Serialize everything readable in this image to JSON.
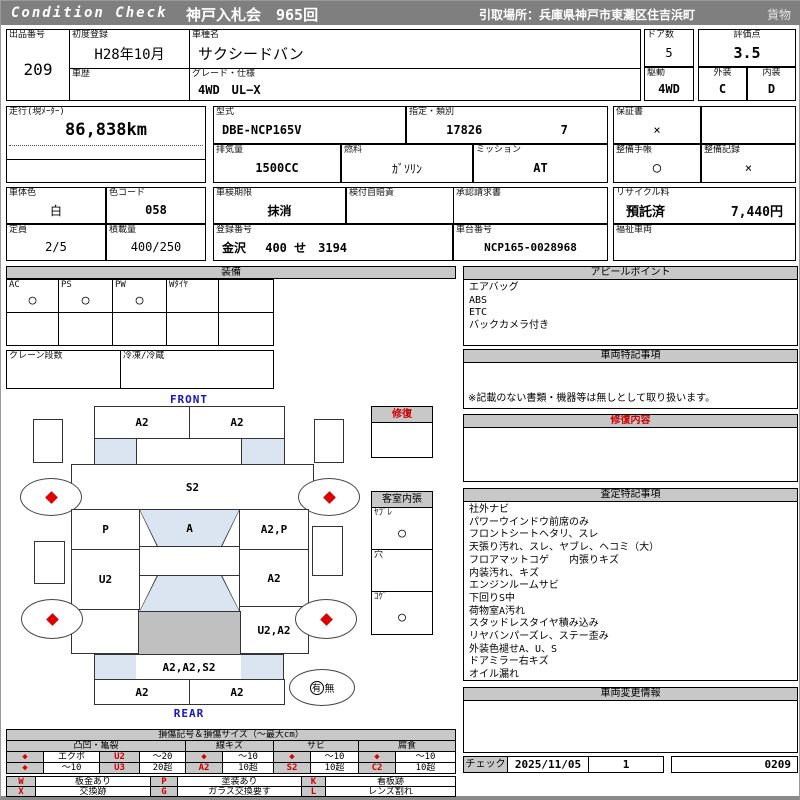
{
  "header": {
    "brand": "Condition Check",
    "auction": "神戸入札会　965回",
    "pickup": "引取場所：兵庫県神戸市東灘区住吉浜町",
    "cargo": "貨物"
  },
  "info": {
    "lot_label": "出品番号",
    "lot": "209",
    "first_reg_label": "初度登録",
    "first_reg": "H28年10月",
    "history_label": "車歴",
    "history": "",
    "model_label": "車種名",
    "model": "サクシードバン",
    "grade_label": "グレード・仕様",
    "grade": "4WD　UL−X",
    "doors_label": "ドア数",
    "doors": "5",
    "drive_label": "駆動",
    "drive": "4WD",
    "score_label": "評価点",
    "score": "3.5",
    "exterior_label": "外装",
    "exterior": "C",
    "interior_label": "内装",
    "interior": "D"
  },
  "specs": {
    "mileage_label": "走行(現ﾒｰﾀｰ)",
    "mileage": "86,838km",
    "model_code_label": "型式",
    "model_code": "DBE-NCP165V",
    "class_label": "指定・類別",
    "class_no": "17826",
    "class_sub": "7",
    "displacement_label": "排気量",
    "displacement": "1500CC",
    "fuel_label": "燃料",
    "fuel": "ｶﾞｿﾘﾝ",
    "transmission_label": "ミッション",
    "transmission": "AT",
    "warranty_label": "保証書",
    "warranty": "×",
    "maintenance_book_label": "整備手帳",
    "maintenance_book": "○",
    "maintenance_record_label": "整備記録",
    "maintenance_record": "×"
  },
  "registration": {
    "color_label": "車体色",
    "color": "白",
    "color_code_label": "色コード",
    "color_code": "058",
    "capacity_label": "定員",
    "capacity": "2/5",
    "load_label": "積載量",
    "load": "400/250",
    "inspection_label": "車検期限",
    "inspection": "抹消",
    "insurance_label": "検付自賠責",
    "insurance": "×",
    "plate_label": "登録番号",
    "plate": "金沢　 400 せ　3194",
    "vin_label": "車台番号",
    "vin": "NCP165-0028968",
    "approval_label": "承認請求書",
    "approval": "",
    "recycle_label": "リサイクル料",
    "recycle_status": "預託済",
    "recycle_fee": "7,440円",
    "welfare_label": "福祉車両",
    "welfare": ""
  },
  "equipment": {
    "title": "装備",
    "items": [
      {
        "label": "AC",
        "value": "○"
      },
      {
        "label": "PS",
        "value": "○"
      },
      {
        "label": "PW",
        "value": "○"
      },
      {
        "label": "Wﾀｲﾔ",
        "value": ""
      },
      {
        "label": "",
        "value": ""
      }
    ],
    "crane_label": "クレーン段数",
    "crane": "",
    "fridge_label": "冷凍/冷蔵",
    "fridge": ""
  },
  "diagram": {
    "front_label": "FRONT",
    "rear_label": "REAR",
    "zones": {
      "front_bumper_l": "A2",
      "front_bumper_r": "A2",
      "hood": "S2",
      "windshield": "A",
      "front_door_l": "P",
      "front_door_r": "A2,P",
      "rear_door_l": "U2",
      "rear_door_r": "A2",
      "rear_quarter_r": "U2,A2",
      "tail_panel": "A2,A2,S2",
      "rear_bumper_l": "A2",
      "rear_bumper_r": "A2"
    },
    "spare_yes": "有",
    "spare_no": "無"
  },
  "repair_box": {
    "title": "修復"
  },
  "interior_trim": {
    "title": "客室内張",
    "tear_label": "ﾔﾌﾞﾚ",
    "tear": "○",
    "hole_label": "穴",
    "hole": "",
    "burn_label": "ｺｹﾞ",
    "burn": "○"
  },
  "panels": {
    "appeal": {
      "title": "アピールポイント",
      "items": [
        "エアバッグ",
        "ABS",
        "ETC",
        "バックカメラ付き"
      ]
    },
    "vehicle_notes": {
      "title": "車両特記事項",
      "note": "※記載のない書類・機器等は無しとして取り扱います。"
    },
    "repair_detail": {
      "title": "修復内容",
      "content": ""
    },
    "assessment": {
      "title": "査定特記事項",
      "items": [
        "社外ナビ",
        "パワーウインドウ前席のみ",
        "フロントシートヘタリ、スレ",
        "天張り汚れ、スレ、ヤブレ、ヘコミ（大）",
        "フロアマットコゲ　　内張りキズ",
        "内装汚れ、キズ",
        "エンジンルームサビ",
        "下回りS中",
        "荷物室A汚れ",
        "スタッドレスタイヤ積み込み",
        "リヤバンパーズレ、ステー歪み",
        "外装色褪せA、U、S",
        "ドアミラー右キズ",
        "オイル漏れ"
      ]
    },
    "change_info": {
      "title": "車両変更情報",
      "content": ""
    }
  },
  "check": {
    "label": "チェック",
    "date": "2025/11/05",
    "count": "1",
    "code": "0209"
  },
  "legend": {
    "title": "損傷記号＆損傷サイズ（〜最大cm）",
    "diamond": "◆",
    "groups": [
      {
        "name": "凸凹・亀裂",
        "rows": [
          [
            "◆",
            "エクボ",
            "U2",
            "〜20"
          ],
          [
            "◆",
            "〜10",
            "U3",
            "20超"
          ]
        ]
      },
      {
        "name": "線キズ",
        "rows": [
          [
            "◆",
            "〜10"
          ],
          [
            "A2",
            "10超"
          ]
        ]
      },
      {
        "name": "サビ",
        "rows": [
          [
            "◆",
            "〜10"
          ],
          [
            "S2",
            "10超"
          ]
        ]
      },
      {
        "name": "腐食",
        "rows": [
          [
            "◆",
            "〜10"
          ],
          [
            "C2",
            "10超"
          ]
        ]
      }
    ],
    "symbols": [
      {
        "code": "W",
        "desc": "板金あり"
      },
      {
        "code": "X",
        "desc": "交換跡"
      },
      {
        "code": "P",
        "desc": "塗装あり"
      },
      {
        "code": "G",
        "desc": "ガラス交換要す"
      },
      {
        "code": "K",
        "desc": "看板跡"
      },
      {
        "code": "L",
        "desc": "レンズ割れ"
      }
    ]
  }
}
